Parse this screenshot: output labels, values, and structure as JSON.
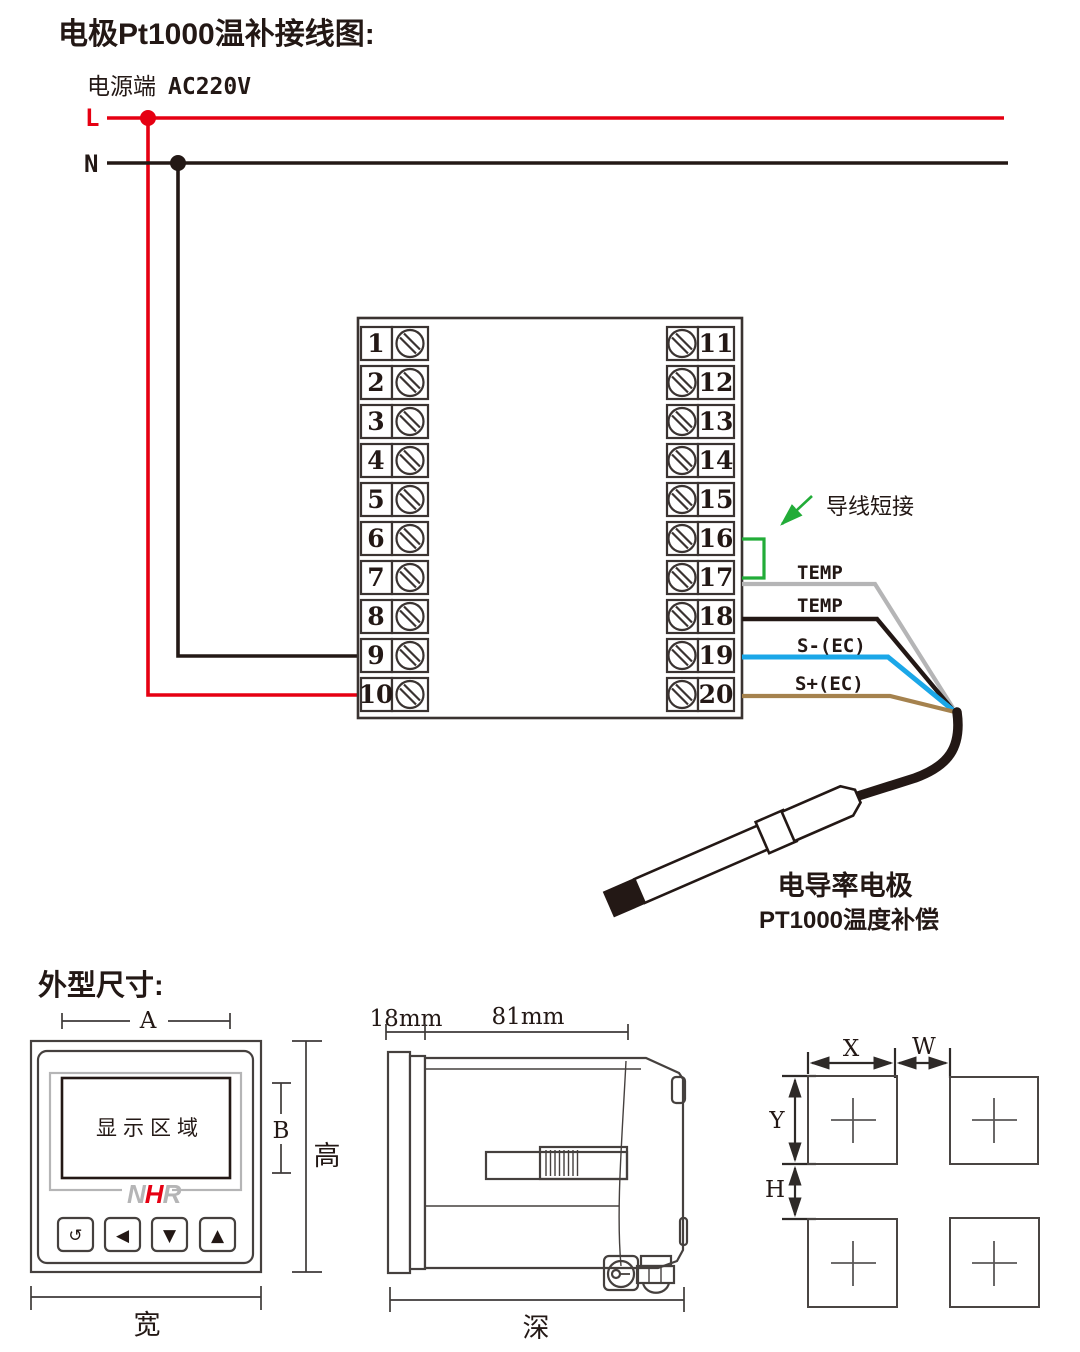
{
  "colors": {
    "line_red": "#e60012",
    "line_black": "#231815",
    "wire_gray": "#b5b5b6",
    "wire_blue": "#1ba7e8",
    "wire_brown": "#a5824e",
    "jumper_green": "#22ac38",
    "logo_gray": "#b5b5b6",
    "logo_red": "#e60012"
  },
  "wiring": {
    "title": "电极Pt1000温补接线图:",
    "power_label": "电源端",
    "power_voltage": "AC220V",
    "line_l": "L",
    "line_n": "N",
    "terminals_left": [
      "1",
      "2",
      "3",
      "4",
      "5",
      "6",
      "7",
      "8",
      "9",
      "10"
    ],
    "terminals_right": [
      "11",
      "12",
      "13",
      "14",
      "15",
      "16",
      "17",
      "18",
      "19",
      "20"
    ],
    "jumper_label": "导线短接",
    "wire_labels": [
      "TEMP",
      "TEMP",
      "S-(EC)",
      "S+(EC)"
    ],
    "probe_title": "电导率电极",
    "probe_subtitle": "PT1000温度补偿"
  },
  "dimensions": {
    "heading": "外型尺寸:",
    "front": {
      "dim_width_top": "A",
      "dim_display_height": "B",
      "height_label": "高",
      "width_label": "宽",
      "display_label": "显示区域",
      "logo": {
        "n": "N",
        "h": "H",
        "r": "R"
      },
      "buttons": [
        "↺",
        "◀",
        "▼",
        "▲"
      ]
    },
    "side": {
      "bezel_depth": "18mm",
      "body_depth": "81mm",
      "depth_label": "深"
    },
    "cutout": {
      "dim_x": "X",
      "dim_w": "W",
      "dim_y": "Y",
      "dim_h": "H"
    }
  }
}
